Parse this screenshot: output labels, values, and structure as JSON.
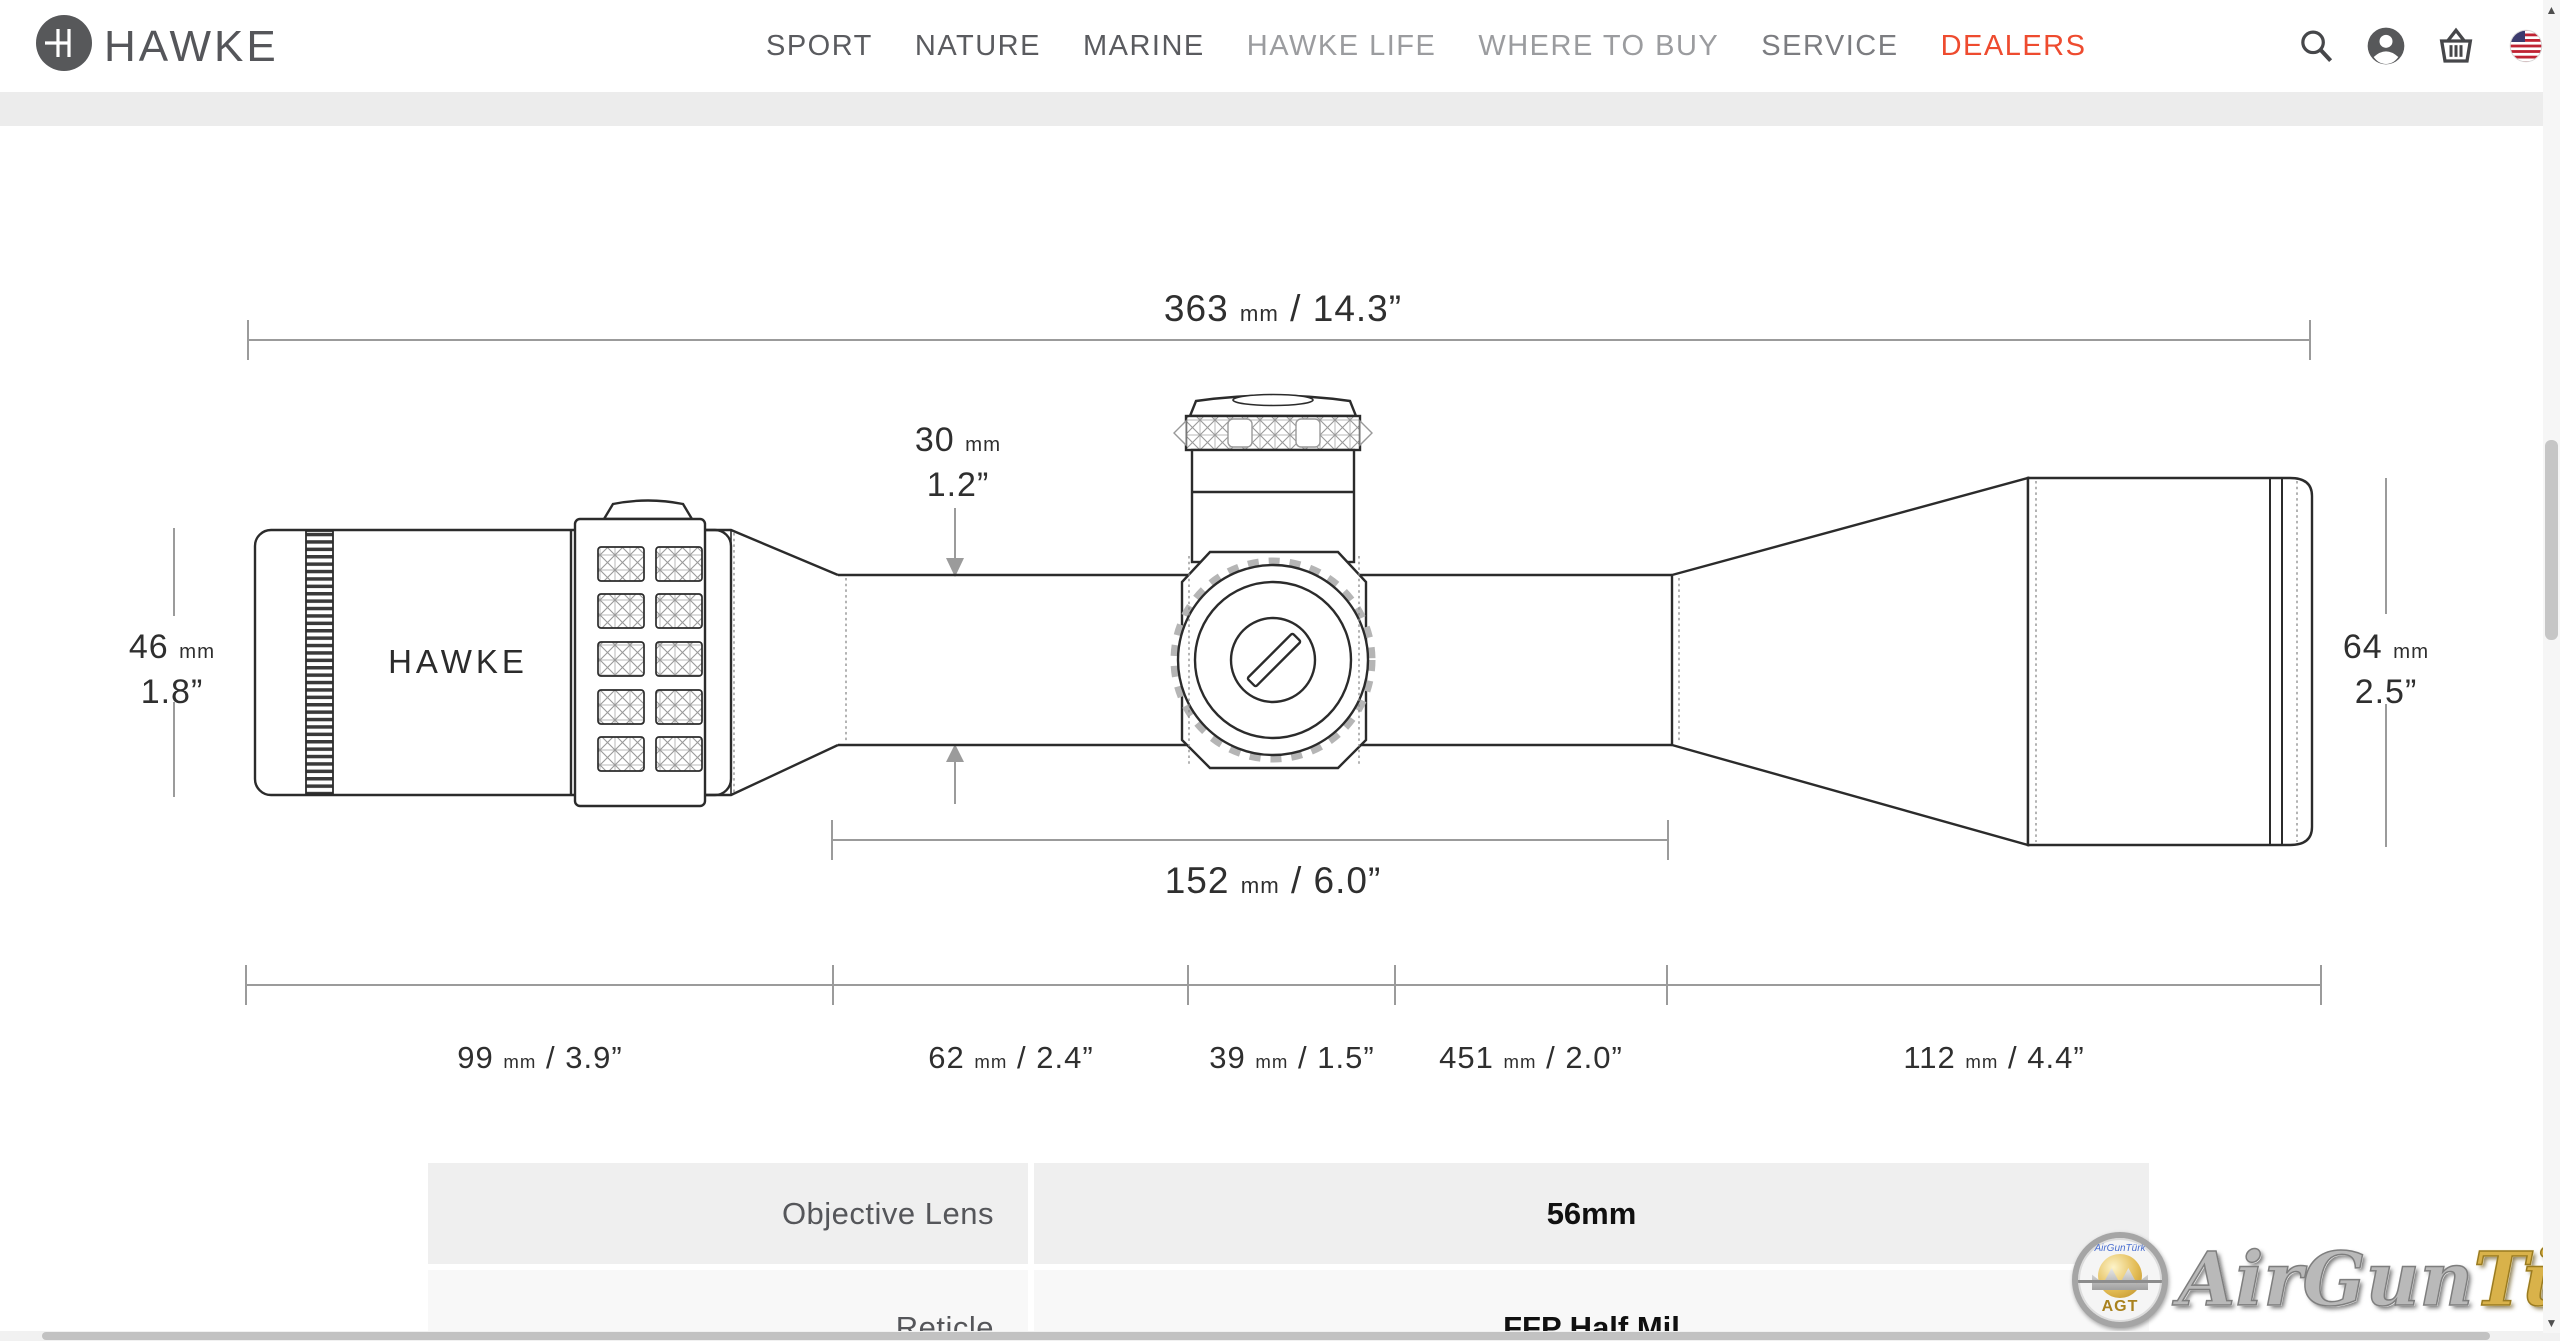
{
  "header": {
    "brand": "HAWKE",
    "nav": [
      {
        "label": "SPORT"
      },
      {
        "label": "NATURE"
      },
      {
        "label": "MARINE"
      },
      {
        "label": "HAWKE LIFE"
      },
      {
        "label": "WHERE TO BUY"
      },
      {
        "label": "SERVICE"
      },
      {
        "label": "DEALERS"
      }
    ],
    "icons": {
      "search": "search-icon",
      "account": "account-icon",
      "basket": "basket-icon",
      "locale": "us-flag-icon"
    }
  },
  "units": {
    "mm": "mm",
    "sep": "/"
  },
  "diagram": {
    "scope_brand": "HAWKE",
    "total": {
      "mm": "363",
      "in": "14.3”"
    },
    "tube": {
      "mm": "30",
      "in": "1.2”"
    },
    "eyepiece": {
      "mm": "46",
      "in": "1.8”"
    },
    "objective": {
      "mm": "64",
      "in": "2.5”"
    },
    "saddle": {
      "mm": "152",
      "in": "6.0”"
    },
    "segments": [
      {
        "mm": "99",
        "in": "3.9”"
      },
      {
        "mm": "62",
        "in": "2.4”"
      },
      {
        "mm": "39",
        "in": "1.5”"
      },
      {
        "mm": "451",
        "in": "2.0”"
      },
      {
        "mm": "112",
        "in": "4.4”"
      }
    ]
  },
  "spec": {
    "rows": [
      {
        "label": "Objective Lens",
        "value": "56mm"
      },
      {
        "label": "Reticle",
        "value": "FFP Half Mil"
      }
    ]
  },
  "watermark": {
    "silver": "AirGun",
    "gold": "Türk",
    "badge": "AGT",
    "script": "AirGunTürk"
  },
  "scroll": {
    "up": "▲",
    "down": "▼"
  },
  "colors": {
    "accent": "#ee4b2f",
    "band": "#ececec",
    "line": "#2b2b2b"
  }
}
